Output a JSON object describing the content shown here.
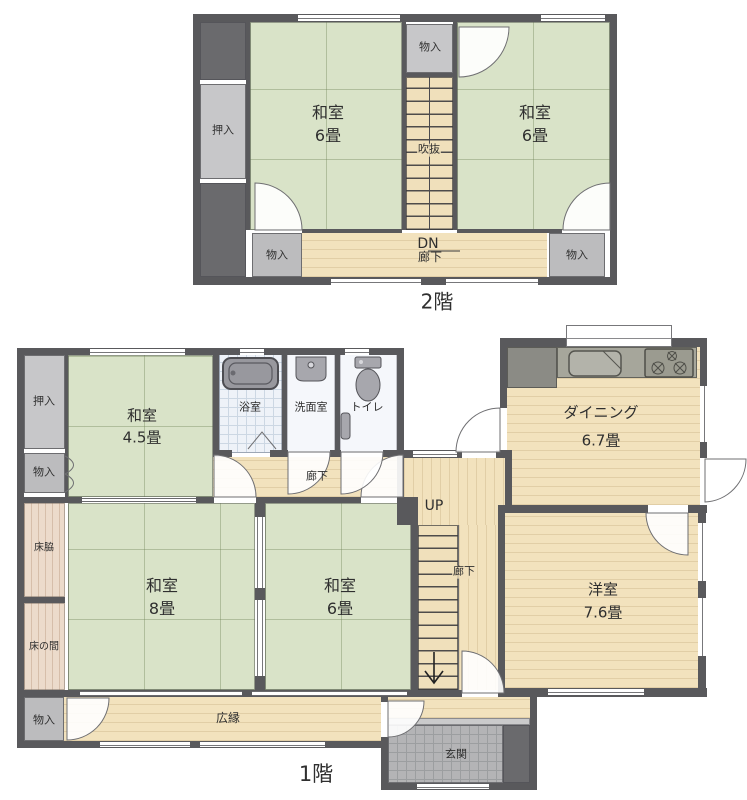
{
  "colors": {
    "wall": "#59595c",
    "tatami_green": "#d9e3c8",
    "wood_floor": "#f2e2bd",
    "closet_light": "#c7c7c9",
    "closet_dark": "#6a6a6d",
    "bath_tile": "#eef2f8",
    "genkan_tile": "#b4b4b6",
    "tokonoma_wood": "#ecdbcb",
    "kitchen_counter": "#a6a69b",
    "text": "#2f2f2f"
  },
  "floor2": {
    "title": "2階",
    "labels": {
      "oshiire": "押入",
      "monoire_top": "物入",
      "monoire_bottom_left": "物入",
      "monoire_bottom_right": "物入",
      "washitsu_left_name": "和室",
      "washitsu_left_size": "6畳",
      "washitsu_right_name": "和室",
      "washitsu_right_size": "6畳",
      "fukinuke": "吹抜",
      "dn": "DN",
      "rouka": "廊下"
    }
  },
  "floor1": {
    "title": "1階",
    "labels": {
      "oshiire": "押入",
      "monoire_left": "物入",
      "monoire_bottom": "物入",
      "washitsu45_name": "和室",
      "washitsu45_size": "4.5畳",
      "yokushitsu": "浴室",
      "senmenshitsu": "洗面室",
      "toire": "トイレ",
      "rouka_top": "廊下",
      "tokowaki": "床脇",
      "tokonoma": "床の間",
      "washitsu8_name": "和室",
      "washitsu8_size": "8畳",
      "washitsu6_name": "和室",
      "washitsu6_size": "6畳",
      "up": "UP",
      "rouka_stairs": "廊下",
      "dining_name": "ダイニング",
      "dining_size": "6.7畳",
      "youshitsu_name": "洋室",
      "youshitsu_size": "7.6畳",
      "hiroen": "広縁",
      "genkan": "玄関"
    }
  }
}
